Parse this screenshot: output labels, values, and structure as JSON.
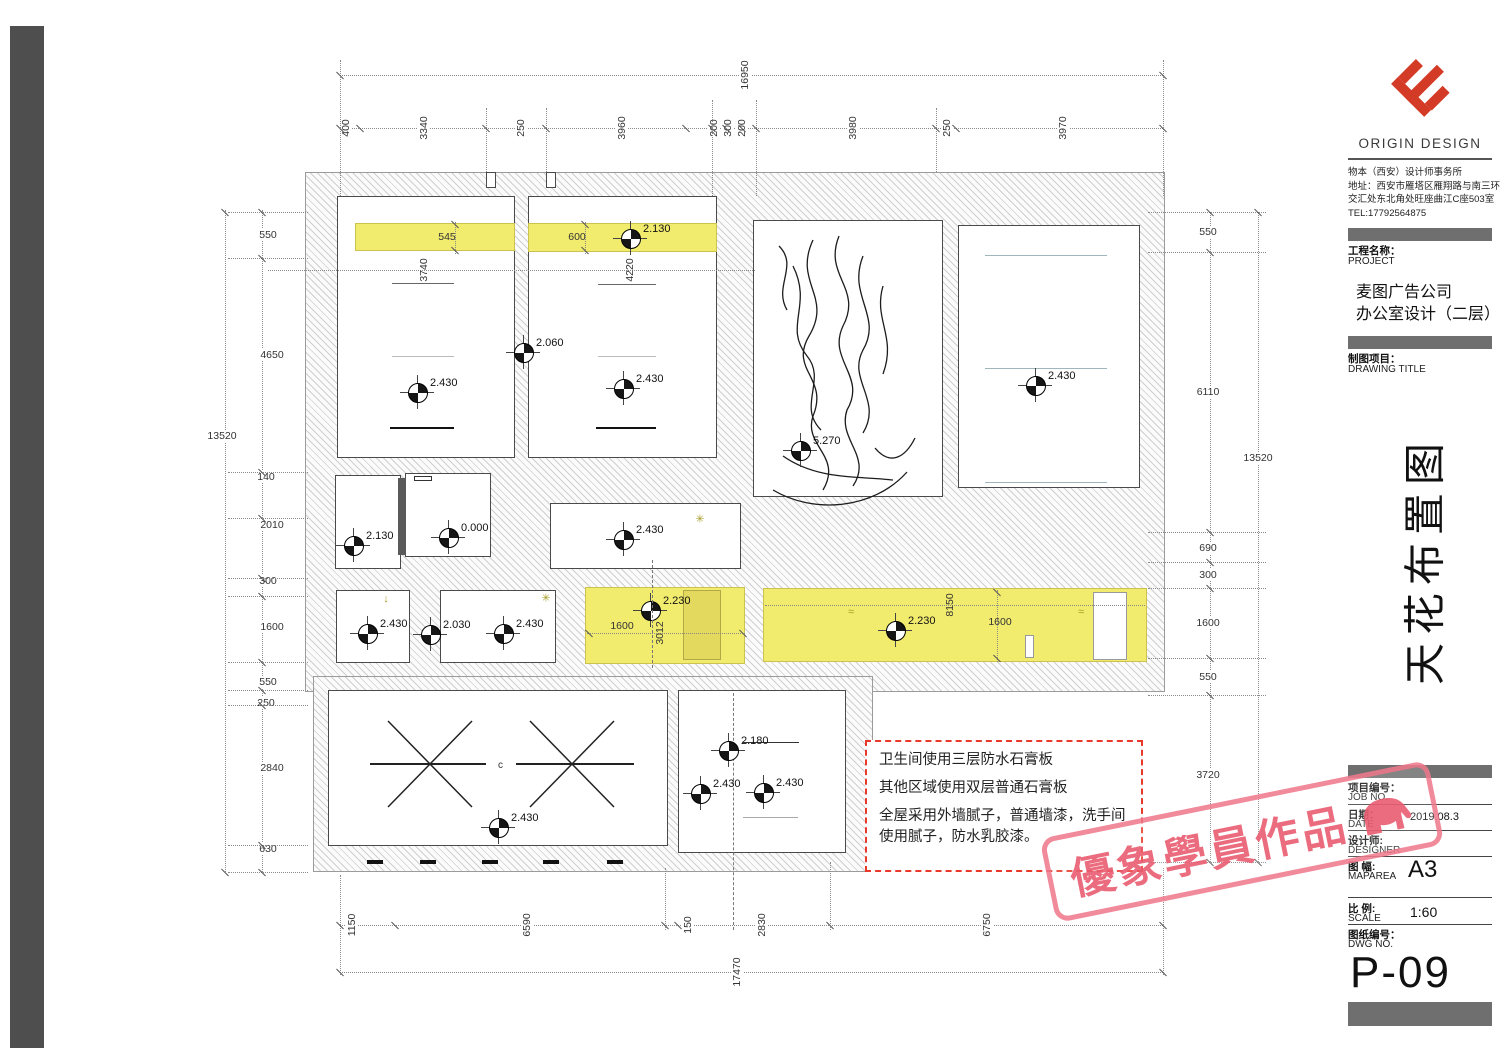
{
  "title_block": {
    "brand": "ORIGIN DESIGN",
    "company_line1": "物本（西安）设计师事务所",
    "company_line2": "地址：西安市雁塔区雁翔路与南三环",
    "company_line3": "交汇处东北角处旺座曲江C座503室",
    "company_line4": "TEL:17792564875",
    "project_label": "工程名称：",
    "project_label_en": "PROJECT",
    "project_name_line1": "麦图广告公司",
    "project_name_line2": "办公室设计（二层）",
    "drawing_title_label": "制图项目：",
    "drawing_title_label_en": "DRAWING TITLE",
    "drawing_title": "天花布置图",
    "job_no_label": "项目编号：",
    "job_no_label_en": "JOB NO.",
    "date_label": "日期：",
    "date_label_en": "DATE",
    "date_value": "2019.08.3",
    "designer_label": "设计师:",
    "designer_label_en": "DESIGNER",
    "map_area_label": "图 幅:",
    "map_area_label_en": "MAPAREA",
    "map_area_value": "A3",
    "scale_label": "比 例:",
    "scale_label_en": "SCALE",
    "scale_value": "1:60",
    "dwg_no_label": "图纸编号：",
    "dwg_no_label_en": "DWG NO.",
    "dwg_no_value": "P-09"
  },
  "stamp": {
    "text": "優象學員作品"
  },
  "notes": {
    "line1": "卫生间使用三层防水石膏板",
    "line2": "其他区域使用双层普通石膏板",
    "line3": "全屋采用外墙腻子，普通墙漆，洗手间使用腻子，防水乳胶漆。"
  },
  "markers": [
    "2.130",
    "2.060",
    "2.430",
    "2.430",
    "2.430",
    "5.270",
    "2.130",
    "0.000",
    "2.430",
    "2.430",
    "2.030",
    "2.430",
    "2.230",
    "2.230",
    "2.430",
    "2.180",
    "2.430",
    "2.430"
  ],
  "dims": {
    "top_overall": "16950",
    "top": [
      "400",
      "3340",
      "250",
      "3960",
      "200",
      "300",
      "200",
      "3980",
      "250",
      "3970"
    ],
    "bottom": [
      "1150",
      "6590",
      "150",
      "2830",
      "6750"
    ],
    "bottom_overall": "17470",
    "left": [
      "550",
      "4650",
      "140",
      "2010",
      "300",
      "1600",
      "550",
      "250",
      "2840",
      "630"
    ],
    "left_overall": "13520",
    "right": [
      "550",
      "6110",
      "690",
      "300",
      "1600",
      "550",
      "3720"
    ],
    "right_overall": "13520",
    "room1_width": "3740",
    "room2_width": "4220",
    "band1": "545",
    "band2": "600",
    "yellow_room_width": "1600",
    "yellow_room_depth": "3012",
    "corridor_length": "8150",
    "corridor_width": "1600"
  },
  "plan": {
    "center_label": "c",
    "glyphs": [
      "↓",
      "✳",
      "≈",
      "≈",
      "✳"
    ]
  }
}
